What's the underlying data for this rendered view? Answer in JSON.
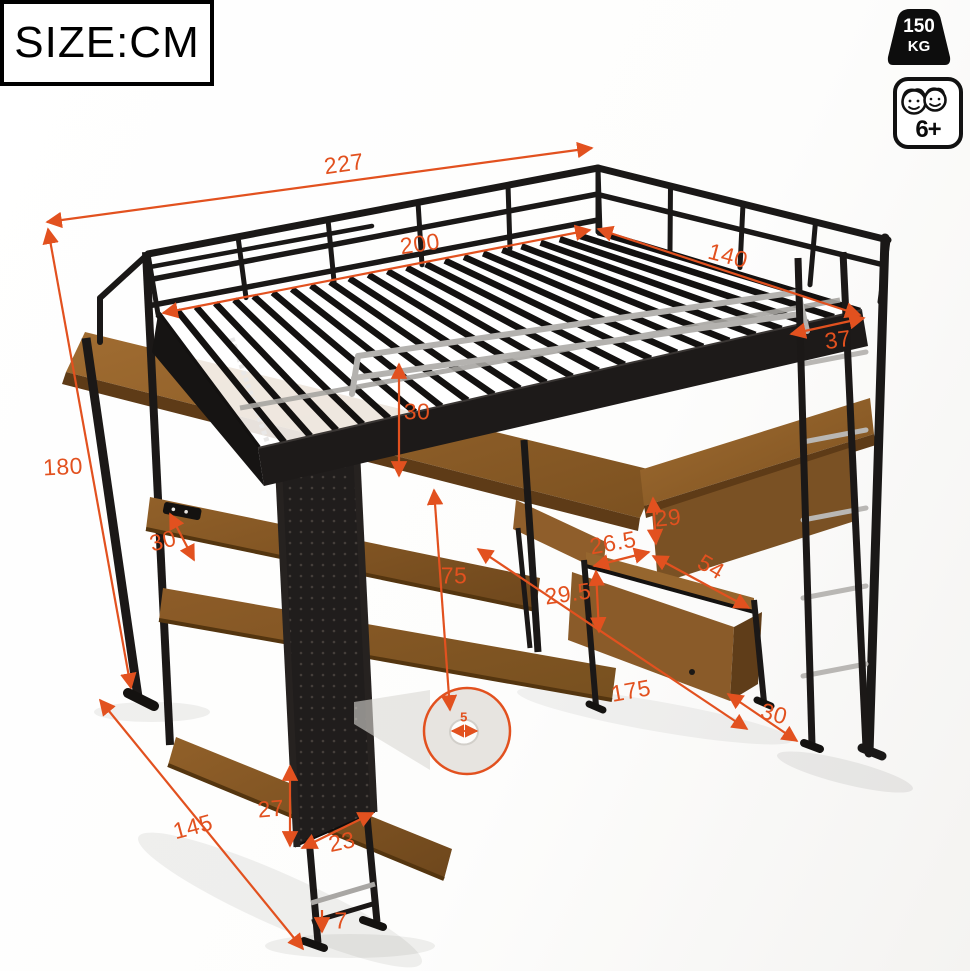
{
  "size_label": "SIZE:CM",
  "weight_badge": {
    "value": "150",
    "unit": "KG"
  },
  "age_badge": {
    "label": "6+"
  },
  "accent_color": "#e2511f",
  "dims": {
    "total_length": "227",
    "sleeping_length": "200",
    "sleeping_width": "140",
    "guardrail_height": "37",
    "total_height": "180",
    "shelf_depth": "30",
    "front_rail_height": "30",
    "under_desk_clearance": "75",
    "cubby_opening_height": "29",
    "mid_shelf_depth": "26.5",
    "mid_shelf_width": "54",
    "cabinet_height": "29.5",
    "desk_length": "175",
    "side_shelf_depth": "30",
    "panel_lower_height": "27",
    "panel_width": "23",
    "base_depth": "145",
    "foot_height": "7",
    "peg_hole_diameter": "5"
  }
}
